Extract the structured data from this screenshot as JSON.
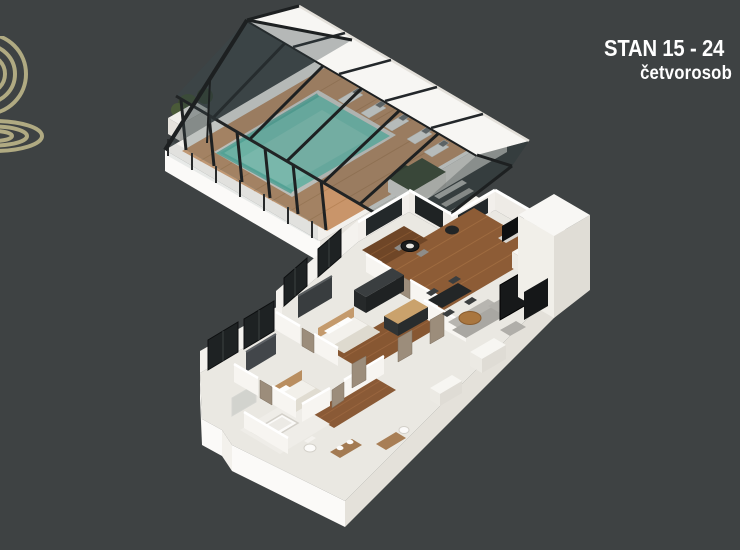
{
  "page": {
    "width": 740,
    "height": 550,
    "background_color": "#3e4243"
  },
  "header": {
    "title": "STAN 15 - 24",
    "subtitle": "četvorosob",
    "text_color": "#ffffff"
  },
  "logo": {
    "color": "#b0aa82"
  },
  "illustration": {
    "type": "isometric-3d-floor-plan-render",
    "palette": {
      "pool_water": "#7dd6c3",
      "pool_water_light": "#94e0cf",
      "deck_wood": "#c9956a",
      "interior_wood_floor": "#8d5c36",
      "structure_frame": "#1d2021",
      "walls_white": "#f2efeb",
      "slab": "#eae8e2",
      "roof_panels": "#f7f6f3",
      "foliage_green": "#3c4c30",
      "furniture_gray": "#b7b5b0",
      "kitchen_dark": "#2c3031",
      "door_wood": "#9c8d7b"
    },
    "parts": [
      "glass pool pavilion",
      "swimming pool",
      "wood deck",
      "sun loungers",
      "planter boxes",
      "stairs",
      "apartment cutaway",
      "living room",
      "kitchen",
      "dining area",
      "bedrooms",
      "bathrooms",
      "elevator volume"
    ]
  }
}
